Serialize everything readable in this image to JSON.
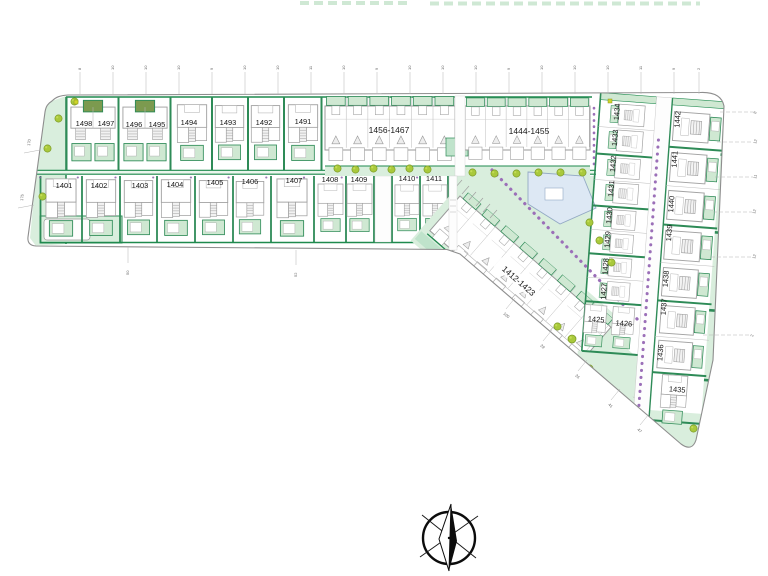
{
  "plan": {
    "type": "residential-development-site-plan",
    "plots": {
      "row_upper": [
        "1498",
        "1497",
        "1496",
        "1495",
        "1494",
        "1493",
        "1492",
        "1491"
      ],
      "row_lower": [
        "1401",
        "1402",
        "1403",
        "1404",
        "1405",
        "1406",
        "1407",
        "1408",
        "1409",
        "1410",
        "1411"
      ],
      "apartment_blocks": [
        "1456-1467",
        "1444-1455",
        "1412-1423"
      ],
      "right_inner_column": [
        "1434",
        "1433",
        "1432",
        "1431",
        "1430",
        "1429",
        "1428",
        "1427"
      ],
      "right_inner_twins": [
        "1425",
        "1426"
      ],
      "right_outer_column": [
        "1442",
        "1441",
        "1440",
        "1439",
        "1438",
        "1437",
        "1436",
        "1435"
      ]
    },
    "dimensions": {
      "top": [
        "8",
        "10",
        "10",
        "10",
        "9",
        "10",
        "10",
        "11",
        "10",
        "9",
        "10",
        "10",
        "10",
        "9",
        "10",
        "10",
        "10",
        "11",
        "9",
        "2"
      ],
      "left": [
        "170",
        "175"
      ],
      "bottom": [
        "50",
        "52"
      ],
      "diagonal": [
        "100",
        "29",
        "26",
        "41",
        "47"
      ],
      "right": [
        "8",
        "12",
        "11",
        "12",
        "12",
        "2"
      ]
    },
    "colors": {
      "hedge": "#2e8b57",
      "hedge_dark": "#1f8a4e",
      "lawn": "#d9eedd",
      "patio": "#cfe8d2",
      "tree": "#a9c93c",
      "shrub": "#9b6fb8",
      "facility": "#dde8f4",
      "boundary": "#8e8e8e"
    },
    "icons": {
      "compass": "north-arrow"
    }
  }
}
